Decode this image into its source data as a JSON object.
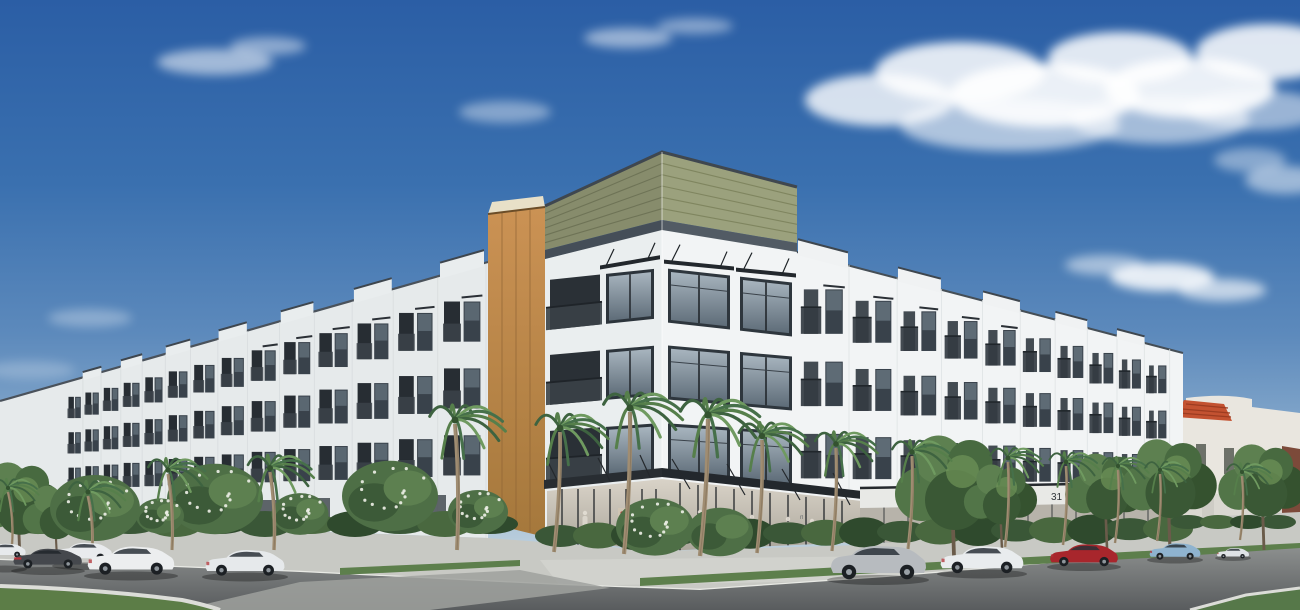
{
  "scene": {
    "type": "architectural rendering",
    "description": "Street-corner view of a four-story white mixed-use apartment building with ground-floor retail, an olive-green horizontal-siding rooftop band, a wood-tone accent column, black metal window awnings and balcony railings, palm-lined sidewalks, parked cars, and a blue sky with scattered white clouds",
    "sky": "blue with scattered white clouds",
    "street": "asphalt road with concrete sidewalks and landscaped median"
  },
  "signage": {
    "window_decal_upper": "rl",
    "window_decal": "que",
    "address_number": "31"
  },
  "building": {
    "stories": 4,
    "facade": "white panel",
    "roof_band": "olive-green horizontal siding with dark coping",
    "accent_column": "wood-tone vertical panel",
    "ground_floor": "glass retail storefronts with black metal awnings",
    "balconies": "dark metal railings",
    "adjacent_building_roof": "red clay tile"
  },
  "vehicles": [
    {
      "label": "white car at left edge",
      "color": "#e7eaec"
    },
    {
      "label": "dark gray coupe",
      "color": "#45484d"
    },
    {
      "label": "white sedan",
      "color": "#e9ebed"
    },
    {
      "label": "white sport sedan",
      "color": "#eceeef"
    },
    {
      "label": "white sedan",
      "color": "#e6e9eb"
    },
    {
      "label": "silver SUV",
      "color": "#b7bbbf"
    },
    {
      "label": "white sedan",
      "color": "#e9ecee"
    },
    {
      "label": "red sedan",
      "color": "#a8262c"
    },
    {
      "label": "light blue sedan",
      "color": "#8fb3cf"
    },
    {
      "label": "white car in distance",
      "color": "#dfe3e6"
    }
  ],
  "vegetation": {
    "palm_trees": 16,
    "shrubs": "white-flowering hedges and green bushes",
    "street_trees": "leafy green trees"
  },
  "palette": {
    "sky_top": "#2b5ea5",
    "sky_horizon": "#d3dfe6",
    "facade_lit": "#f2f4f5",
    "facade_shade": "#e6eaeb",
    "olive_band": "#9ba17d",
    "coping_dark": "#454e58",
    "wood_accent": "#bd8748",
    "window_glass": "#5e6c78",
    "awning_black": "#23282d",
    "palm_green": "#4c7247",
    "hedge_green": "#3f5c3b",
    "asphalt": "#6b6f71",
    "sidewalk": "#c8c9c4",
    "red_tile_roof": "#c35231"
  }
}
